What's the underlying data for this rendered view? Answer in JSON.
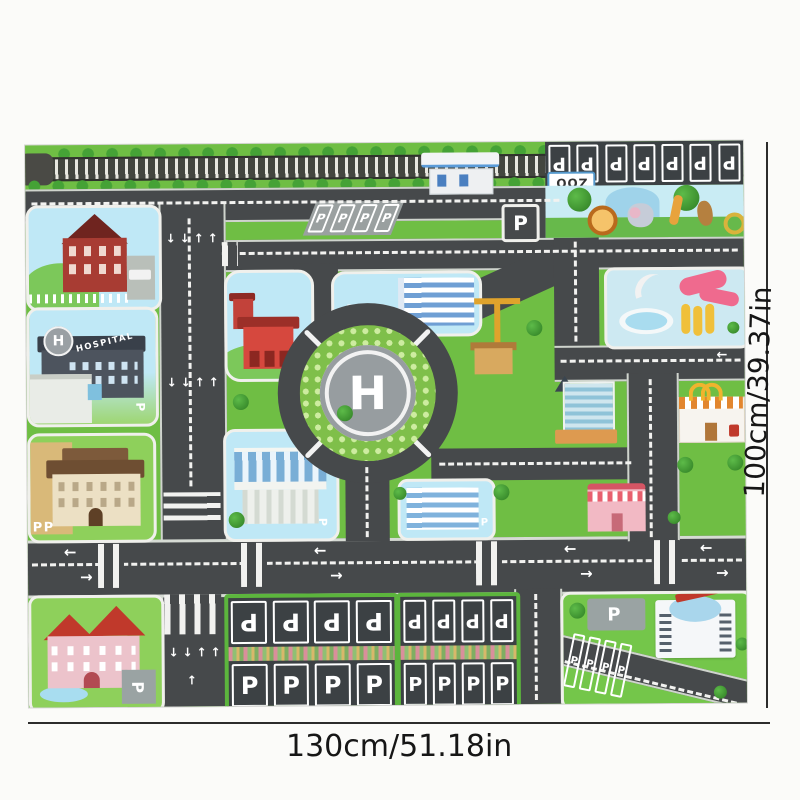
{
  "annotations": {
    "width_label": "130cm/51.18in",
    "height_label": "100cm/39.37in"
  },
  "mat": {
    "zoo_sign": "ZOO",
    "hospital_name": "HOSPITAL",
    "helipad_letter": "H",
    "parking_letter": "P",
    "arrows": {
      "up": "↑",
      "down": "↓",
      "left": "←",
      "right": "→"
    },
    "stall_counts": {
      "zoo_row": 7,
      "lot_a": 8,
      "lot_b": 8,
      "lawn_row": 4,
      "slant_lot": 4
    },
    "colors": {
      "grass": "#6fbe44",
      "road": "#46494b",
      "marking": "#f2f2f0",
      "block_sky": "#bfe8f6",
      "water": "#cde9f2",
      "accent_red": "#d6483e",
      "hedge_pink": "#d98f9b"
    },
    "features": [
      "railway",
      "zoo",
      "water-park",
      "roundabout-helipad",
      "hospital",
      "school",
      "mansion",
      "fire-station",
      "gas-station",
      "parking-lots",
      "shops",
      "crosswalks",
      "lane-arrows"
    ]
  }
}
